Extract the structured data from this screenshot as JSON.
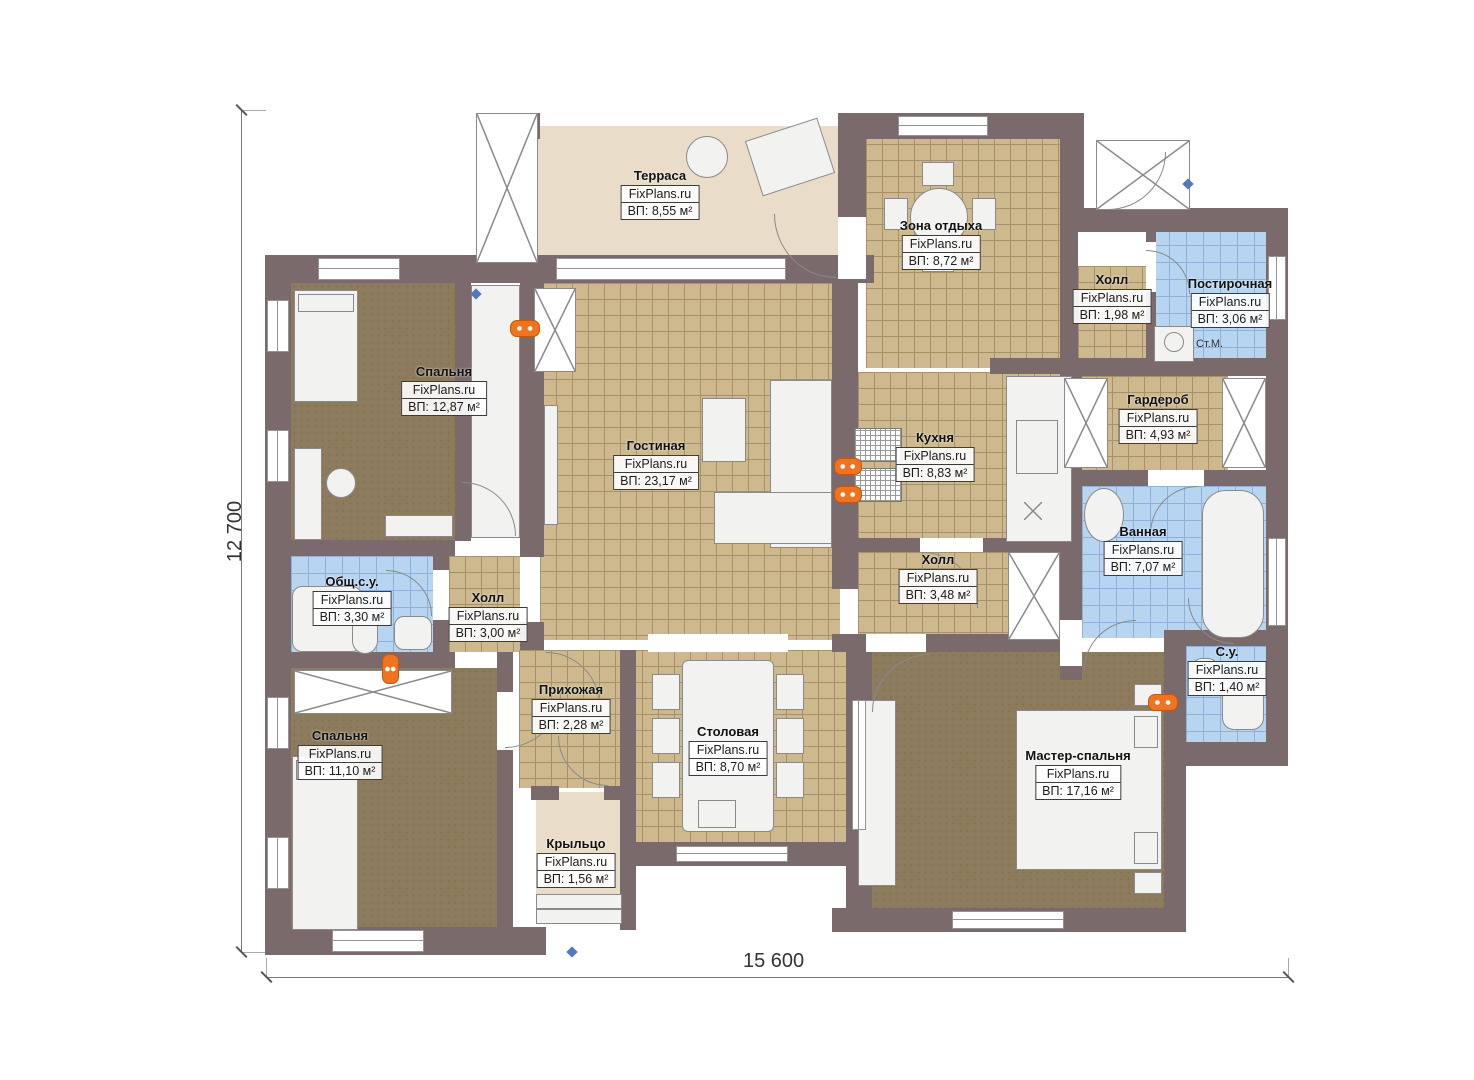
{
  "plan": {
    "watermark": "FixPlans.ru",
    "dim_height": "12 700",
    "dim_width": "15 600",
    "washer_label": "Ст.М.",
    "rooms": [
      {
        "id": "terrace",
        "name": "Терраса",
        "area": "ВП: 8,55 м²"
      },
      {
        "id": "rest_area",
        "name": "Зона отдыха",
        "area": "ВП: 8,72 м²"
      },
      {
        "id": "hall_top",
        "name": "Холл",
        "area": "ВП: 1,98 м²"
      },
      {
        "id": "laundry",
        "name": "Постирочная",
        "area": "ВП: 3,06 м²"
      },
      {
        "id": "bedroom1",
        "name": "Спальня",
        "area": "ВП: 12,87 м²"
      },
      {
        "id": "living",
        "name": "Гостиная",
        "area": "ВП: 23,17 м²"
      },
      {
        "id": "kitchen",
        "name": "Кухня",
        "area": "ВП: 8,83 м²"
      },
      {
        "id": "wardrobe",
        "name": "Гардероб",
        "area": "ВП: 4,93 м²"
      },
      {
        "id": "bathroom",
        "name": "Ванная",
        "area": "ВП: 7,07 м²"
      },
      {
        "id": "wc_common",
        "name": "Общ.с.у.",
        "area": "ВП: 3,30 м²"
      },
      {
        "id": "hall_left",
        "name": "Холл",
        "area": "ВП: 3,00 м²"
      },
      {
        "id": "hall_right",
        "name": "Холл",
        "area": "ВП: 3,48 м²"
      },
      {
        "id": "bedroom2",
        "name": "Спальня",
        "area": "ВП: 11,10 м²"
      },
      {
        "id": "entry",
        "name": "Прихожая",
        "area": "ВП: 2,28 м²"
      },
      {
        "id": "dining",
        "name": "Столовая",
        "area": "ВП: 8,70 м²"
      },
      {
        "id": "porch",
        "name": "Крыльцо",
        "area": "ВП: 1,56 м²"
      },
      {
        "id": "master",
        "name": "Мастер-спальня",
        "area": "ВП: 17,16 м²"
      },
      {
        "id": "wc_small",
        "name": "С.у.",
        "area": "ВП: 1,40 м²"
      }
    ],
    "colors": {
      "wall": "#7b6a6b",
      "tile_tan": "#cdb98d",
      "tile_blue": "#b7d4f1",
      "floor_brown": "#8c7b5d",
      "terrace": "#e9ddc9",
      "radiator": "#f0741f"
    }
  }
}
